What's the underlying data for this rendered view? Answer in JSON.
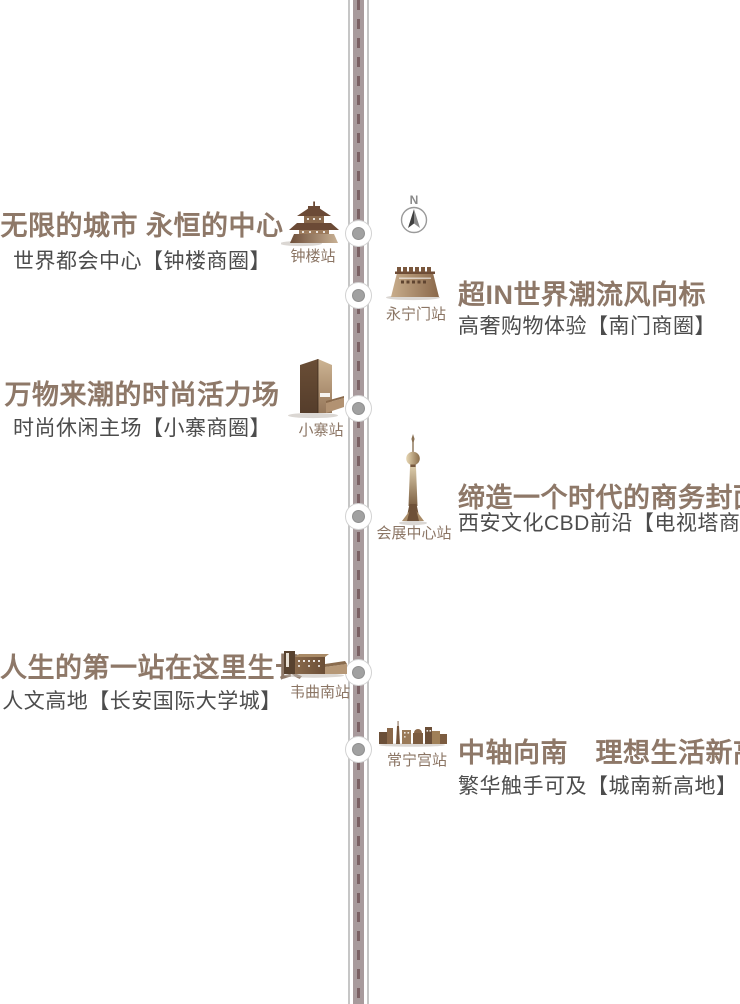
{
  "compass": {
    "label": "N"
  },
  "sections": [
    {
      "side": "left",
      "headline": "无限的城市 永恒的中心",
      "subline": "世界都会中心【钟楼商圈】",
      "station": "钟楼站",
      "icon": "bell-tower"
    },
    {
      "side": "right",
      "headline": "超IN世界潮流风向标",
      "subline": "高奢购物体验【南门商圈】",
      "station": "永宁门站",
      "icon": "city-gate"
    },
    {
      "side": "left",
      "headline": "万物来潮的时尚活力场",
      "subline": "时尚休闲主场【小寨商圈】",
      "station": "小寨站",
      "icon": "modern-tower"
    },
    {
      "side": "right",
      "headline": "缔造一个时代的商务封面",
      "subline": "西安文化CBD前沿【电视塔商圈】",
      "station": "会展中心站",
      "icon": "tv-tower"
    },
    {
      "side": "left",
      "headline": "人生的第一站在这里生长",
      "subline": "人文高地【长安国际大学城】",
      "station": "韦曲南站",
      "icon": "campus"
    },
    {
      "side": "right",
      "headline": "中轴向南　理想生活新高地",
      "subline": "繁华触手可及【城南新高地】",
      "station": "常宁宫站",
      "icon": "skyline"
    }
  ],
  "colors": {
    "headline": "#8e7868",
    "subline": "#4c4c4c",
    "station_label": "#8b7564",
    "road_fill": "#a89a9c",
    "road_edge": "#c6c6c6",
    "road_dash": "#7b6164",
    "dot_core": "#a1a1a1",
    "icon_brown_dark": "#6b4a36",
    "icon_brown_light": "#c9b195"
  }
}
